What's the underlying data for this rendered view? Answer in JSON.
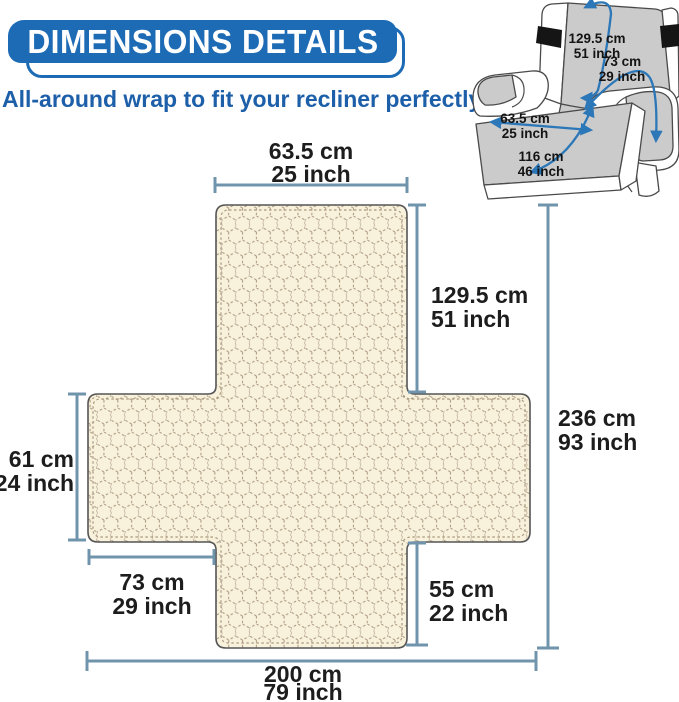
{
  "header": {
    "title": "DIMENSIONS DETAILS",
    "subtitle": "All-around wrap to fit your recliner perfectly."
  },
  "colors": {
    "brand_blue": "#1d6bb5",
    "subtitle_blue": "#1d5fa8",
    "dimension_line": "#7094ac",
    "fabric_bg": "#f8f1dc",
    "fabric_stitch": "#a8967a",
    "label_text": "#1d1d1d",
    "arrow_blue": "#2b77b8",
    "chair_gray": "#cbcbcb",
    "strap_black": "#151515"
  },
  "diagram": {
    "top_width": {
      "cm": "63.5 cm",
      "inch": "25 inch"
    },
    "backrest_length": {
      "cm": "129.5 cm",
      "inch": "51 inch"
    },
    "total_length": {
      "cm": "236 cm",
      "inch": "93 inch"
    },
    "left_height": {
      "cm": "61 cm",
      "inch": "24 inch"
    },
    "left_width": {
      "cm": "73 cm",
      "inch": "29 inch"
    },
    "front_height": {
      "cm": "55 cm",
      "inch": "22 inch"
    },
    "total_width": {
      "cm": "200 cm",
      "inch": "79 inch"
    }
  },
  "recliner": {
    "back_length": {
      "cm": "129.5 cm",
      "inch": "51 inch"
    },
    "arm_width": {
      "cm": "73 cm",
      "inch": "29 inch"
    },
    "seat_width": {
      "cm": "63.5 cm",
      "inch": "25 inch"
    },
    "seat_length": {
      "cm": "116 cm",
      "inch": "46 inch"
    }
  }
}
